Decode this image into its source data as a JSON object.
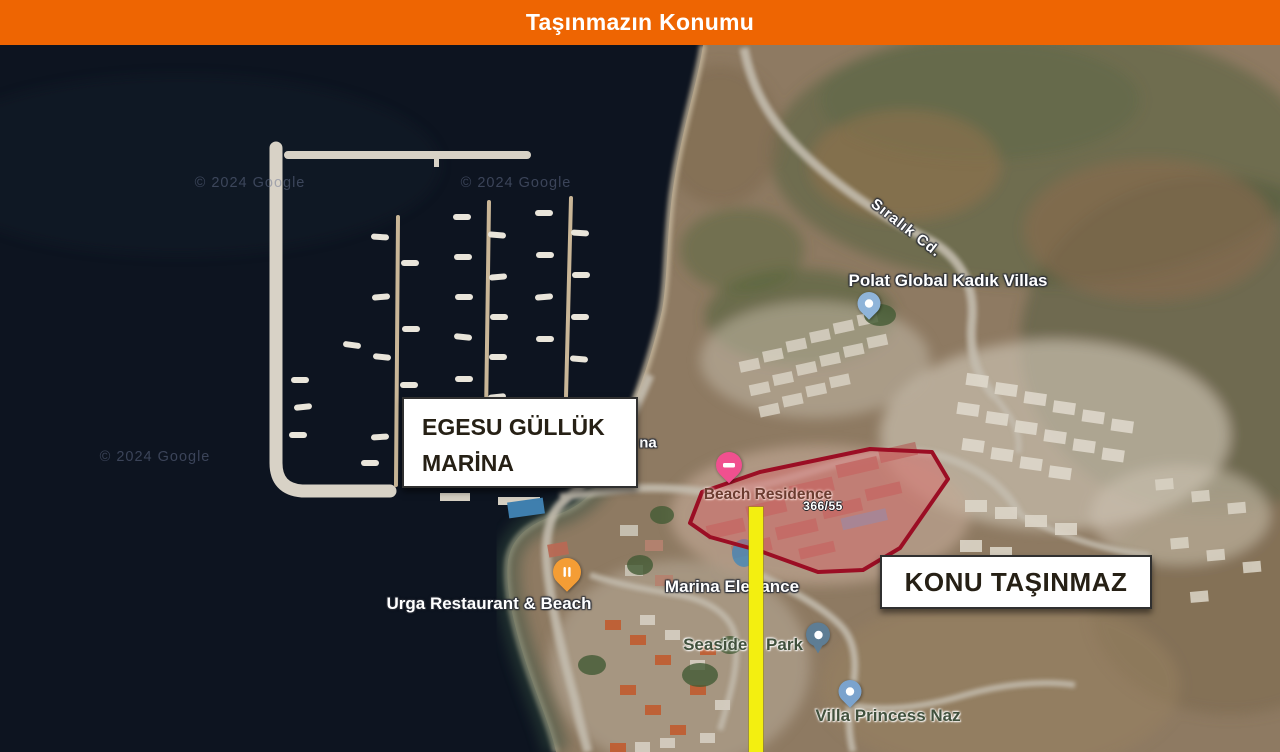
{
  "header": {
    "title": "Taşınmazın Konumu",
    "bg_color": "#EE6502",
    "text_color": "#FFFFFF"
  },
  "map": {
    "attribution": "© 2024 Google",
    "callouts": {
      "marina_box": {
        "line1": "EGESU GÜLLÜK",
        "line2": "MARİNA"
      },
      "subject_box": {
        "label": "KONU TAŞINMAZ"
      }
    },
    "labels": {
      "polat_villas": "Polat Global Kadık Villas",
      "siralik_road": "Sıralık Cd.",
      "urga": "Urga Restaurant & Beach",
      "marina_elegance": "Marina Elegance",
      "seaside_park": "Seaside Park",
      "villa_princess": "Villa Princess Naz",
      "beach_residence": "Beach Residence",
      "parcel_no": "366/55",
      "fragment": "na"
    },
    "highlight": {
      "outline_color": "#9B0E24",
      "fill_color": "rgba(219,92,98,0.42)",
      "marker_line_color": "#F3EF10"
    },
    "pins": {
      "restaurant": {
        "color": "#F49D35"
      },
      "lodging_pink": {
        "color": "#F0508F"
      },
      "lodging_blue_polat": {
        "color": "#8FB4D9"
      },
      "park": {
        "color": "#5E7D94"
      },
      "lodging_blue_princess": {
        "color": "#7BA3CD"
      }
    }
  }
}
